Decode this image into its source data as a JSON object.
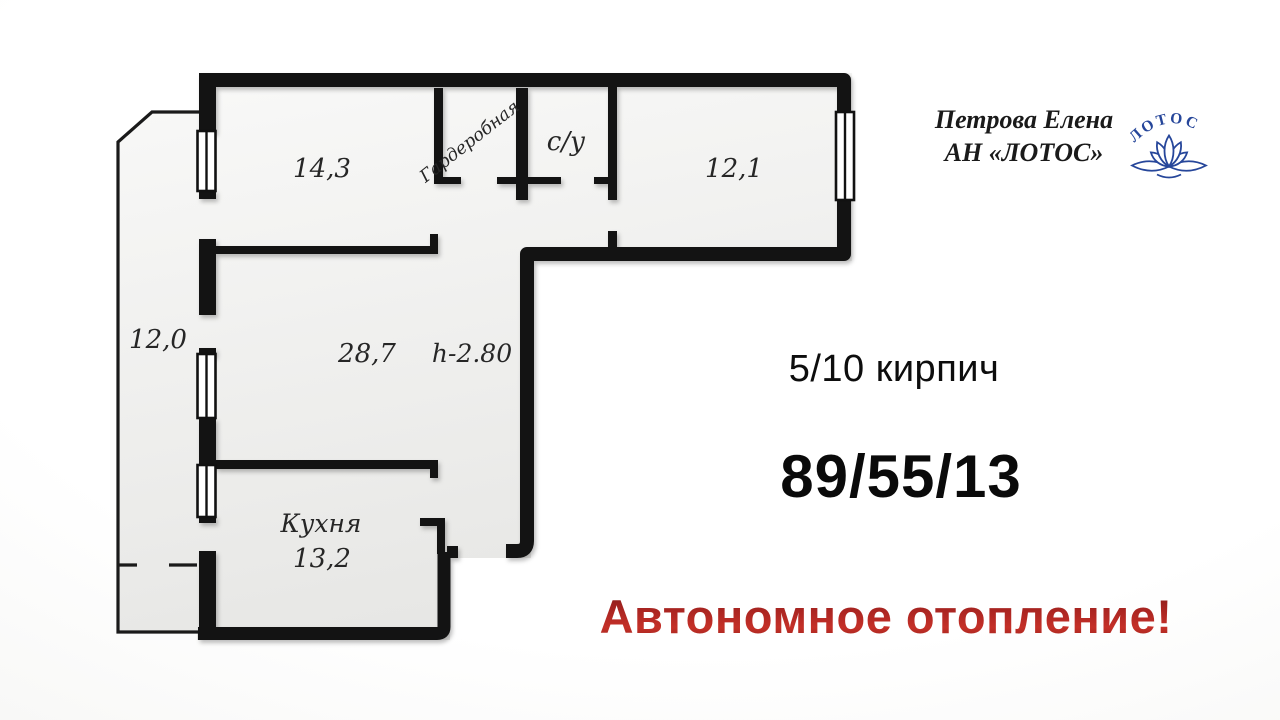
{
  "agent": {
    "name": "Петрова Елена",
    "agency": "АН «ЛОТОС»",
    "logo_text": "ЛОТОС"
  },
  "listing": {
    "floor_info": "5/10 кирпич",
    "area_numbers": "89/55/13",
    "highlight": "Автономное отопление!"
  },
  "floorplan": {
    "labels": {
      "room1": "14,3",
      "wardrobe": "Гардеробная",
      "bathroom": "с/у",
      "room2": "12,1",
      "loggia": "12,0",
      "living": "28,7",
      "ceiling": "h-2.80",
      "kitchen": "Кухня",
      "kitchen_area": "13,2"
    }
  },
  "colors": {
    "wall": "#131313",
    "logo_blue": "#26469a",
    "highlight_red": "#a82420"
  }
}
